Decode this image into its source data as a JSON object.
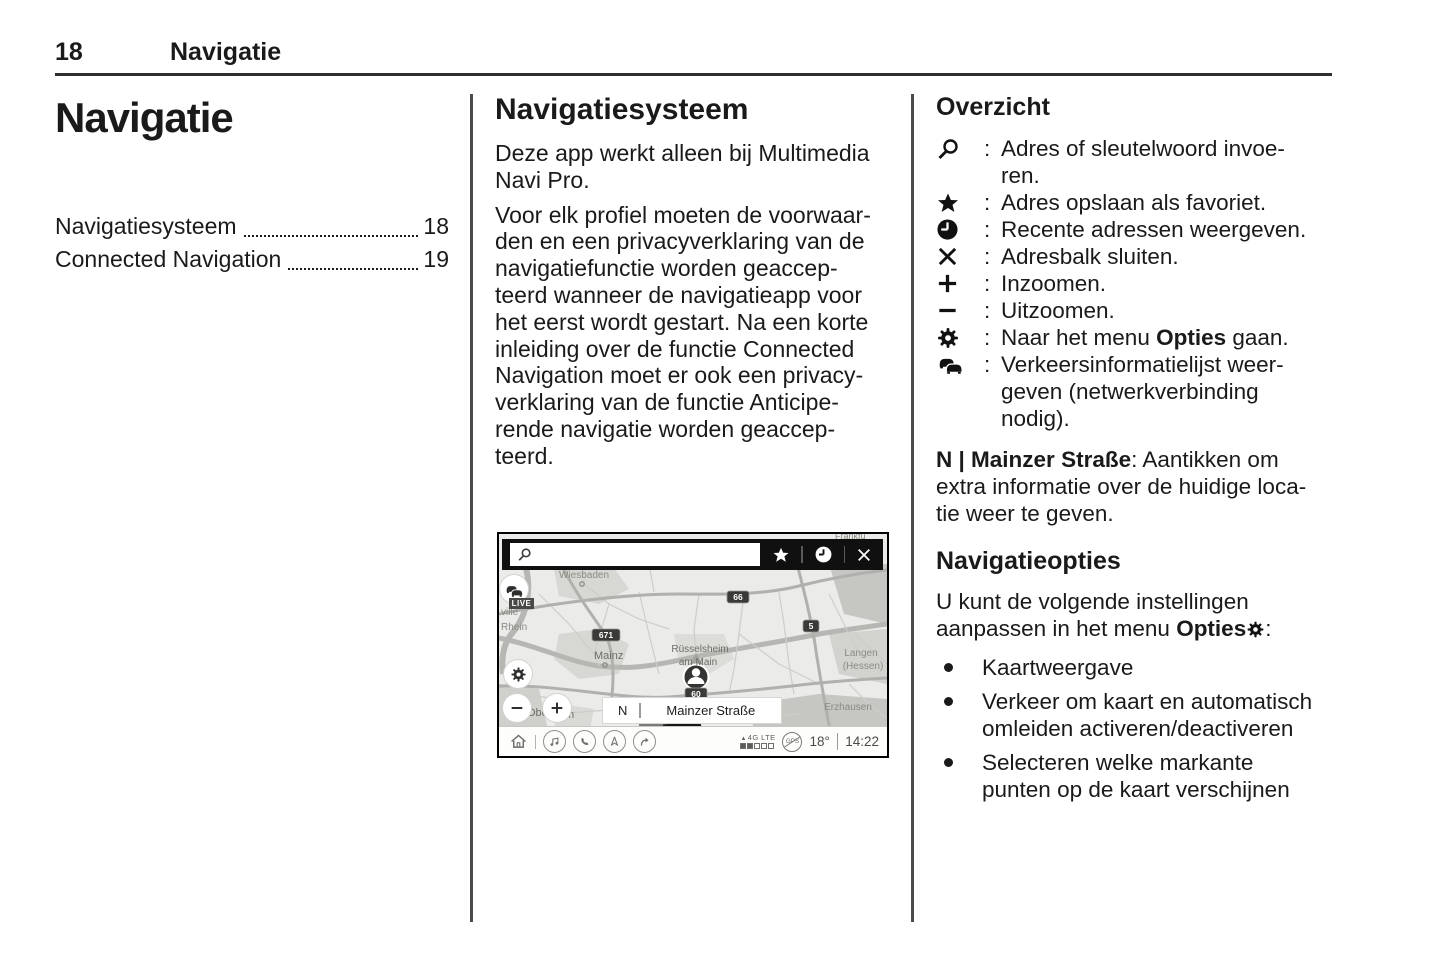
{
  "header": {
    "page_number": "18",
    "chapter": "Navigatie"
  },
  "left_column": {
    "title": "Navigatie",
    "toc": [
      {
        "label": "Navigatiesysteem",
        "page": "18"
      },
      {
        "label": "Connected Navigation",
        "page": "19"
      }
    ]
  },
  "middle_column": {
    "heading": "Navigatiesysteem",
    "paragraph_1": "Deze app werkt alleen bij Multimedia\nNavi Pro.",
    "paragraph_2": "Voor elk profiel moeten de voorwaar-\nden en een privacyverklaring van de\nnavigatiefunctie worden geaccep-\nteerd wanneer de navigatieapp voor\nhet eerst wordt gestart. Na een korte\ninleiding over de functie Connected\nNavigation moet er ook een privacy-\nverklaring van de functie Anticipe-\nrende navigatie worden geaccep-\nteerd."
  },
  "right_column": {
    "heading_overview": "Overzicht",
    "colon": ":",
    "overview_items": [
      {
        "icon": "search-icon",
        "text": "Adres of sleutelwoord invoe-\nren."
      },
      {
        "icon": "favorite-star-icon",
        "text": "Adres opslaan als favoriet."
      },
      {
        "icon": "recent-clock-icon",
        "text": "Recente adressen weergeven."
      },
      {
        "icon": "close-icon",
        "text": "Adresbalk sluiten."
      },
      {
        "icon": "zoom-in-icon",
        "text": "Inzoomen."
      },
      {
        "icon": "zoom-out-icon",
        "text": "Uitzoomen."
      },
      {
        "icon": "options-gear-icon",
        "text_before": "Naar het menu ",
        "text_bold": "Opties",
        "text_after": " gaan."
      },
      {
        "icon": "traffic-icon",
        "text": "Verkeersinformatielijst weer-\ngeven (netwerkverbinding\nnodig)."
      }
    ],
    "location_note": {
      "bold": "N | Mainzer Straße",
      "rest": ": Aantikken om\nextra informatie over de huidige loca-\ntie weer te geven."
    },
    "heading_options": "Navigatieopties",
    "options_intro": {
      "before": "U kunt de volgende instellingen\naanpassen in het menu ",
      "bold": "Opties",
      "after": ":"
    },
    "bullets": [
      "Kaartweergave",
      "Verkeer om kaart en automatisch\nomleiden activeren/deactiveren",
      "Selecteren welke markante\npunten op de kaart verschijnen"
    ]
  },
  "screenshot": {
    "live_badge": "LIVE",
    "location_bar": {
      "compass": "N",
      "street": "Mainzer Straße"
    },
    "status_bar": {
      "network": "4G LTE",
      "gps": "GPS",
      "temperature": "18°",
      "time": "14:22"
    },
    "map_labels": [
      {
        "text": "Frankfu",
        "x": 0,
        "y": 0,
        "html": true
      },
      {
        "text": "Wiesbaden",
        "x": 85,
        "y": 44,
        "size": 10,
        "anchor": "middle"
      },
      {
        "text": "ville",
        "x": 2,
        "y": 81,
        "size": 10,
        "anchor": "start"
      },
      {
        "text": "Rhein",
        "x": 2,
        "y": 96,
        "size": 10,
        "anchor": "start"
      },
      {
        "text": "Mainz",
        "x": 95,
        "y": 125,
        "size": 11,
        "anchor": "start",
        "color": "#6d6d67"
      },
      {
        "text": "Rüsselsheim",
        "x": 201,
        "y": 118,
        "size": 10,
        "anchor": "middle",
        "color": "#6d6d67"
      },
      {
        "text": "am Main",
        "x": 199,
        "y": 131,
        "size": 10,
        "anchor": "middle",
        "color": "#6d6d67"
      },
      {
        "text": "Langen",
        "x": 362,
        "y": 122,
        "size": 10,
        "anchor": "middle"
      },
      {
        "text": "(Hessen)",
        "x": 364,
        "y": 135,
        "size": 10,
        "anchor": "middle"
      },
      {
        "text": "Erzhausen",
        "x": 349,
        "y": 176,
        "size": 10,
        "anchor": "middle"
      },
      {
        "text": "Obe",
        "x": 28,
        "y": 182,
        "size": 11,
        "anchor": "start",
        "color": "#6d6d67"
      },
      {
        "text": "m",
        "x": 66,
        "y": 184,
        "size": 11,
        "anchor": "start",
        "color": "#6d6d67"
      }
    ],
    "road_badges": [
      {
        "text": "66",
        "x": 239,
        "y": 63
      },
      {
        "text": "671",
        "x": 107,
        "y": 101
      },
      {
        "text": "5",
        "x": 312,
        "y": 92
      },
      {
        "text": "60",
        "x": 197,
        "y": 160
      }
    ]
  }
}
